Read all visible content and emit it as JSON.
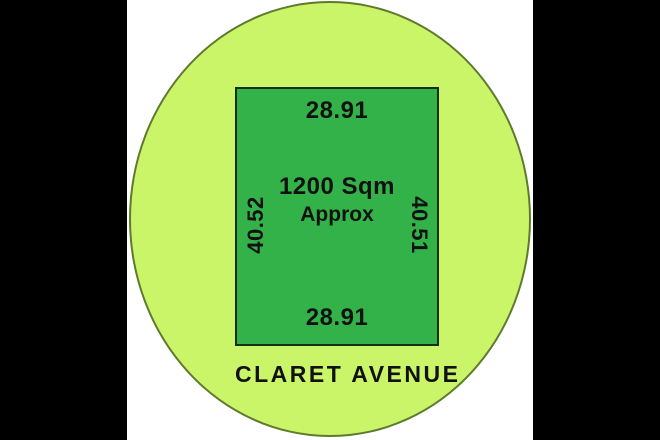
{
  "diagram": {
    "type": "land-lot-plan",
    "street_name": "CLARET AVENUE",
    "lot": {
      "area_line1": "1200 Sqm",
      "area_line2": "Approx",
      "dimensions": {
        "top": "28.91",
        "bottom": "28.91",
        "left": "40.52",
        "right": "40.51"
      }
    },
    "colors": {
      "lot_fill": "#33b24a",
      "lot_border": "#143014",
      "surround_fill": "#cbf568",
      "surround_outline": "#5e7a2d",
      "panel_background": "#ffffff",
      "letterbox_background": "#000000",
      "text": "#111111"
    }
  }
}
